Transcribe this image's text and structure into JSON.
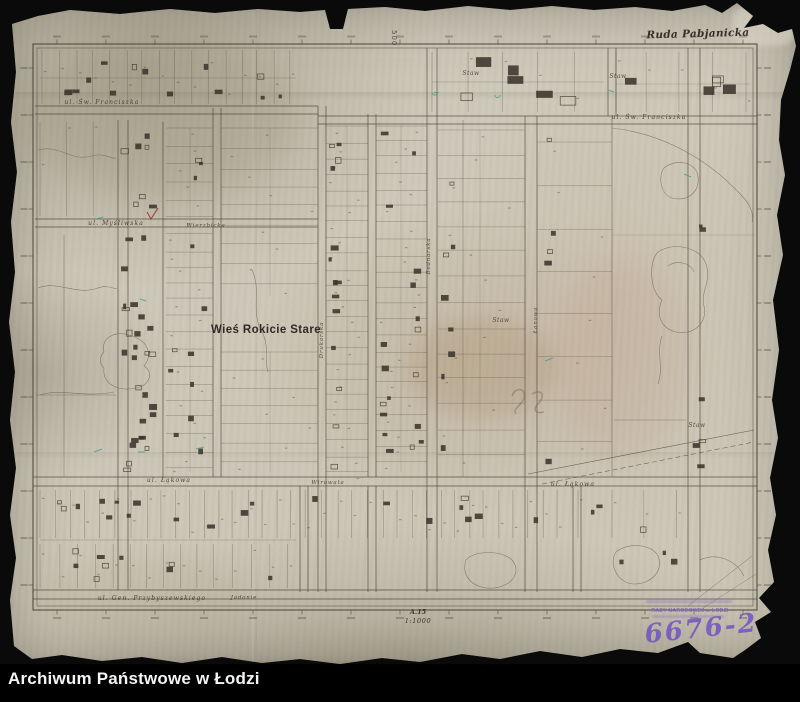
{
  "footer": {
    "archive_name": "Archiwum Państwowe w Łodzi"
  },
  "map": {
    "region_label": "Ruda Pabjanicka",
    "village_label": "Wieś Rokicie Stare",
    "sheet_number": "A.15",
    "scale_label": "1:1000",
    "grid_number": "500",
    "pond_label": "Staw",
    "streets": {
      "franciszka_left": "ul. Św. Franciszka",
      "franciszka_right": "ul. Św. Franciszka",
      "mysliwska": "ul. Myśliwska",
      "wierzbicka": "Wierzbicka",
      "lakowa_left": "ul. Łąkowa",
      "lakowa_right": "ul. Łąkowa",
      "wirowata": "Wirowata",
      "przybyszewskiego": "ul. Gen. Przybyszewskiego",
      "jadonie": "Jadonie",
      "drukarska": "Drukarska",
      "bednarska": "Bednarska",
      "lanowa": "Łanowa"
    },
    "stamp": {
      "office_line": "RADY NARODOWEJ w ŁODZI",
      "inventory_number": "6676-2"
    },
    "colors": {
      "paper": "#cfcabb",
      "ink": "#4a453a",
      "stamp": "#6e50c2",
      "teal_note": "#3fa392"
    }
  }
}
